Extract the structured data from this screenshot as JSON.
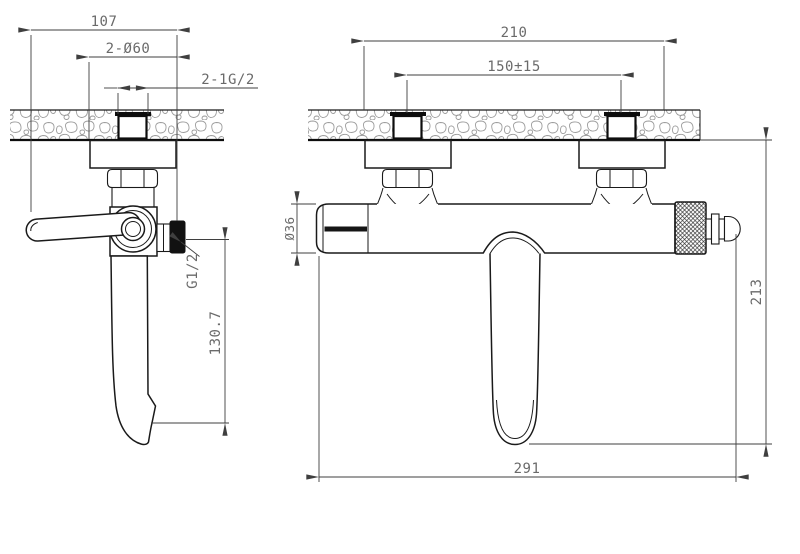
{
  "colors": {
    "background": "#ffffff",
    "part_outline": "#1a1a1a",
    "dimension_line": "#3f3f3f",
    "dimension_text": "#6a6a6a",
    "wall_texture": "#9c9c9c",
    "solid_black_fill": "#111111"
  },
  "dimensions": {
    "side_view": {
      "overall_width": "107",
      "escutcheon_diameter": "2-Ø60",
      "inlet_thread": "2-1G/2",
      "outlet_thread": "G1/2",
      "outlet_to_spout": "130.7"
    },
    "front_view": {
      "escutcheon_span": "210",
      "inlet_spacing": "150±15",
      "body_diameter": "Ø36",
      "wall_to_spout": "213",
      "overall_length": "291"
    }
  }
}
